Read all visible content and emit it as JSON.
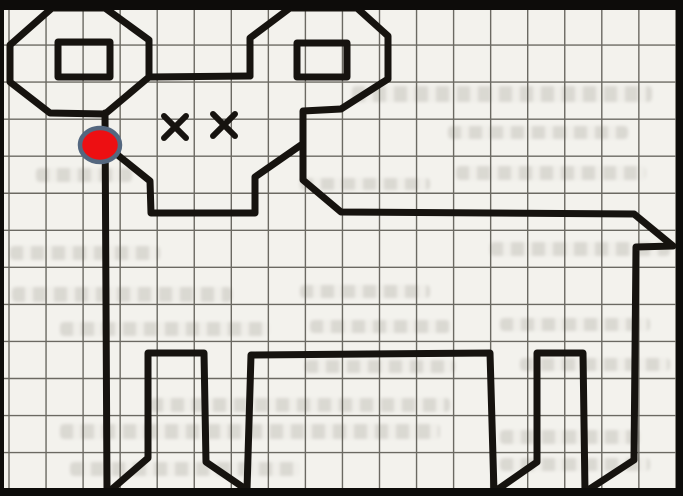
{
  "scene": {
    "kind": "scanned-graph-paper-drawing-of-ram",
    "canvas": {
      "width": 683,
      "height": 496,
      "paper_color": "#f3f2ed"
    },
    "frame": {
      "color": "#0d0c0a",
      "top": 10,
      "bottom": 8,
      "left": 4,
      "right": 7
    },
    "grid": {
      "origin_x": 9,
      "origin_y": 8,
      "cell": 37.05,
      "col_lines": 19,
      "row_lines": 14,
      "color": "#4a4840",
      "line_width": 1.4,
      "opacity": 0.8
    },
    "figure": {
      "stroke": "#16130f",
      "stroke_width": 7,
      "polylines": [
        {
          "name": "left-horn-outline",
          "closed": true,
          "points": [
            [
              52,
              8
            ],
            [
              105,
              8
            ],
            [
              149,
              40
            ],
            [
              149,
              77
            ],
            [
              105,
              114
            ],
            [
              50,
              113
            ],
            [
              10,
              82
            ],
            [
              10,
              45
            ]
          ]
        },
        {
          "name": "left-horn-inner-square",
          "closed": true,
          "points": [
            [
              58,
              42
            ],
            [
              110,
              42
            ],
            [
              110,
              77
            ],
            [
              58,
              77
            ]
          ]
        },
        {
          "name": "forehead-line",
          "closed": false,
          "points": [
            [
              149,
              77
            ],
            [
              250,
              76
            ]
          ]
        },
        {
          "name": "right-horn-inner-square",
          "closed": true,
          "points": [
            [
              297,
              43
            ],
            [
              347,
              43
            ],
            [
              347,
              77
            ],
            [
              297,
              77
            ]
          ]
        },
        {
          "name": "body-outline",
          "closed": false,
          "points": [
            [
              250,
              76
            ],
            [
              250,
              38
            ],
            [
              290,
              8
            ],
            [
              357,
              8
            ],
            [
              388,
              36
            ],
            [
              388,
              79
            ],
            [
              341,
              109
            ],
            [
              303,
              111
            ],
            [
              303,
              180
            ],
            [
              341,
              212
            ],
            [
              634,
              214
            ],
            [
              673,
              246
            ],
            [
              636,
              247
            ],
            [
              634,
              460
            ],
            [
              585,
              492
            ],
            [
              583,
              353
            ],
            [
              537,
              353
            ],
            [
              537,
              462
            ],
            [
              494,
              492
            ],
            [
              490,
              353
            ],
            [
              251,
              355
            ],
            [
              247,
              490
            ],
            [
              206,
              462
            ],
            [
              204,
              353
            ],
            [
              148,
              353
            ],
            [
              148,
              458
            ],
            [
              111,
              490
            ],
            [
              107,
              490
            ],
            [
              105,
              113
            ]
          ]
        },
        {
          "name": "muzzle-line",
          "closed": false,
          "points": [
            [
              104,
              144
            ],
            [
              150,
              181
            ],
            [
              151,
              213
            ],
            [
              255,
              213
            ],
            [
              255,
              177
            ],
            [
              301,
              145
            ]
          ]
        }
      ]
    },
    "eyes": {
      "stroke": "#16130f",
      "stroke_width": 6,
      "arm": 11,
      "points": [
        {
          "cx": 175,
          "cy": 127
        },
        {
          "cx": 224,
          "cy": 125
        }
      ]
    },
    "start_dot": {
      "cx": 100,
      "cy": 145,
      "rx": 20,
      "ry": 17,
      "fill": "#ed0f12",
      "ring_color": "#54677f",
      "ring_width": 4.5
    },
    "smudges": [
      [
        352,
        86,
        300,
        16
      ],
      [
        448,
        126,
        180,
        13
      ],
      [
        36,
        168,
        96,
        14
      ],
      [
        456,
        166,
        190,
        14
      ],
      [
        300,
        178,
        130,
        12
      ],
      [
        10,
        246,
        150,
        14
      ],
      [
        490,
        242,
        180,
        14
      ],
      [
        12,
        287,
        220,
        15
      ],
      [
        300,
        285,
        130,
        13
      ],
      [
        60,
        322,
        210,
        14
      ],
      [
        310,
        320,
        140,
        13
      ],
      [
        500,
        318,
        150,
        13
      ],
      [
        305,
        360,
        150,
        13
      ],
      [
        520,
        358,
        150,
        13
      ],
      [
        150,
        398,
        300,
        14
      ],
      [
        60,
        424,
        380,
        15
      ],
      [
        500,
        430,
        140,
        14
      ],
      [
        70,
        462,
        230,
        14
      ],
      [
        500,
        458,
        150,
        13
      ]
    ]
  }
}
